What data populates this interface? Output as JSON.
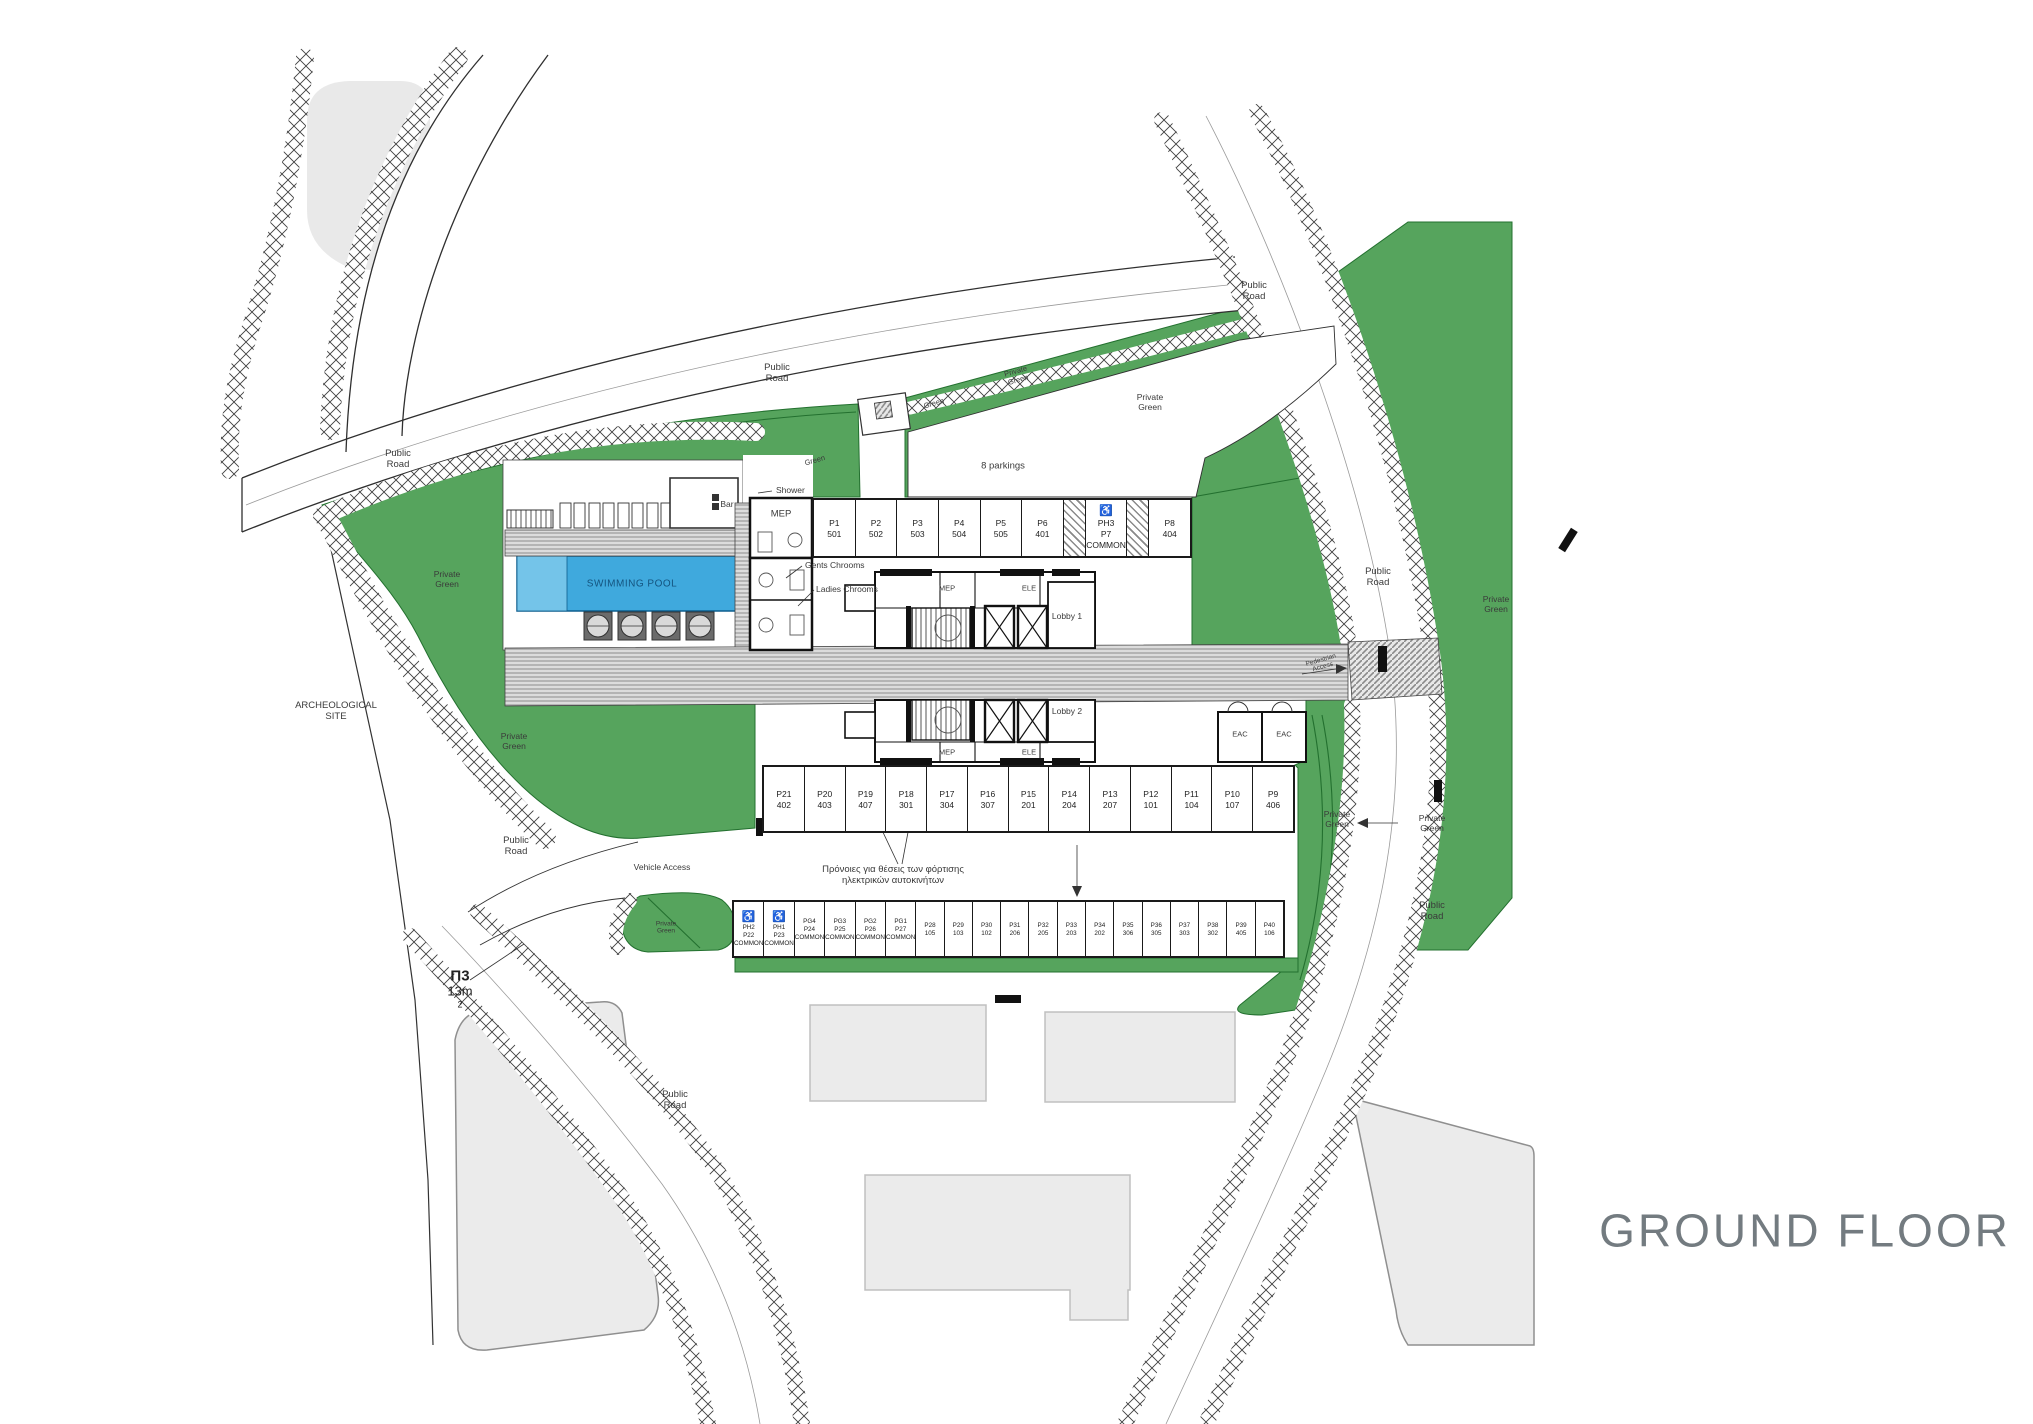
{
  "title": "GROUND FLOOR",
  "plot": {
    "id": "Π3",
    "area": "13m",
    "area_sup": "2"
  },
  "colors": {
    "green": "#56a45d",
    "green_line": "#23702f",
    "pool_blue": "#3fa9dd",
    "pool_blue_light": "#74c4e9",
    "walkway_gray": "#dcdcdc",
    "blob_gray": "#e9e9e9",
    "title_gray": "#737b80"
  },
  "site_labels": {
    "archeological_1": "ARCHEOLOGICAL",
    "archeological_2": "SITE",
    "public": "Public",
    "road": "Road",
    "private": "Private",
    "green": "Green",
    "swimming_pool": "SWIMMING POOL",
    "shower": "Shower",
    "bar": "Bar",
    "mep": "MEP",
    "ele": "ELE",
    "eac": "EAC",
    "gents": "Gents Chrooms",
    "ladies": "Ladies Chrooms",
    "lobby1": "Lobby 1",
    "lobby2": "Lobby 2",
    "vehicle_access": "Vehicle Access",
    "pedestrian_access_1": "Pedestrian",
    "pedestrian_access_2": "Access",
    "parkings_note": "8 parkings",
    "ev_note_1": "Πρόνοιες για θέσεις των φόρτισης",
    "ev_note_2": "ηλεκτρικών αυτοκινήτων"
  },
  "parking_rows": {
    "top": [
      {
        "l1": "P1",
        "l2": "501"
      },
      {
        "l1": "P2",
        "l2": "502"
      },
      {
        "l1": "P3",
        "l2": "503"
      },
      {
        "l1": "P4",
        "l2": "504"
      },
      {
        "l1": "P5",
        "l2": "505"
      },
      {
        "l1": "P6",
        "l2": "401"
      },
      {
        "hatch": true
      },
      {
        "l1": "PH3",
        "l2": "P7",
        "l3": "COMMON",
        "handicap": true
      },
      {
        "hatch": true
      },
      {
        "l1": "P8",
        "l2": "404"
      }
    ],
    "middle": [
      {
        "l1": "P21",
        "l2": "402"
      },
      {
        "l1": "P20",
        "l2": "403"
      },
      {
        "l1": "P19",
        "l2": "407"
      },
      {
        "l1": "P18",
        "l2": "301"
      },
      {
        "l1": "P17",
        "l2": "304"
      },
      {
        "l1": "P16",
        "l2": "307"
      },
      {
        "l1": "P15",
        "l2": "201"
      },
      {
        "l1": "P14",
        "l2": "204"
      },
      {
        "l1": "P13",
        "l2": "207"
      },
      {
        "l1": "P12",
        "l2": "101"
      },
      {
        "l1": "P11",
        "l2": "104"
      },
      {
        "l1": "P10",
        "l2": "107"
      },
      {
        "l1": "P9",
        "l2": "406"
      }
    ],
    "bottom": [
      {
        "l1": "PH2",
        "l2": "P22",
        "l3": "COMMON",
        "handicap": true
      },
      {
        "l1": "PH1",
        "l2": "P23",
        "l3": "COMMON",
        "handicap": true
      },
      {
        "l1": "PG4",
        "l2": "P24",
        "l3": "COMMON"
      },
      {
        "l1": "PG3",
        "l2": "P25",
        "l3": "COMMON"
      },
      {
        "l1": "PG2",
        "l2": "P26",
        "l3": "COMMON"
      },
      {
        "l1": "PG1",
        "l2": "P27",
        "l3": "COMMON"
      },
      {
        "l1": "P28",
        "l2": "105"
      },
      {
        "l1": "P29",
        "l2": "103"
      },
      {
        "l1": "P30",
        "l2": "102"
      },
      {
        "l1": "P31",
        "l2": "206"
      },
      {
        "l1": "P32",
        "l2": "205"
      },
      {
        "l1": "P33",
        "l2": "203"
      },
      {
        "l1": "P34",
        "l2": "202"
      },
      {
        "l1": "P35",
        "l2": "306"
      },
      {
        "l1": "P36",
        "l2": "305"
      },
      {
        "l1": "P37",
        "l2": "303"
      },
      {
        "l1": "P38",
        "l2": "302"
      },
      {
        "l1": "P39",
        "l2": "405"
      },
      {
        "l1": "P40",
        "l2": "106"
      }
    ]
  }
}
